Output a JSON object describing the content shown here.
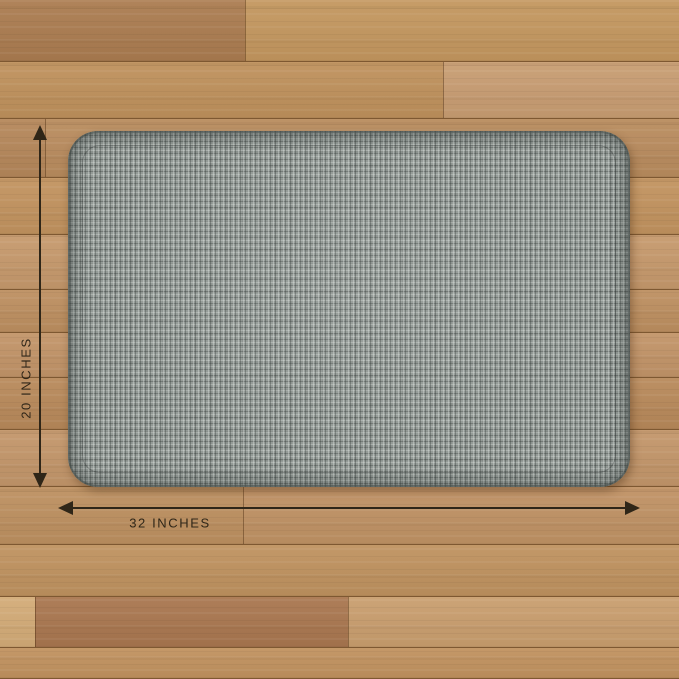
{
  "image": {
    "type": "product-dimension-photo",
    "subject": "Heather gray woven anti-fatigue floor mat lying on a wooden plank floor",
    "mat": {
      "texture": "fine woven crosshatch fabric, rounded corners, beveled edge",
      "width_label": "32 INCHES",
      "height_label": "20 INCHES"
    }
  },
  "annotations": {
    "height_dimension": {
      "label": "20 INCHES",
      "orientation": "vertical"
    },
    "width_dimension": {
      "label": "32 INCHES",
      "orientation": "horizontal"
    }
  },
  "colors": {
    "annotation": "#2f2618",
    "mat_base": "#949b97",
    "mat_light_thread": "#c3c8c4",
    "mat_dark_thread": "#4f5553",
    "mat_edge": "#6b736f",
    "floor_base": "#bf915c",
    "plank_seam": "rgba(72,42,14,0.55)"
  },
  "floor": {
    "plank_rows": [
      {
        "top": 0,
        "height": 62,
        "boards": [
          {
            "left": 0,
            "color": "#ab7c50"
          },
          {
            "left": 245,
            "color": "#c4975f"
          }
        ]
      },
      {
        "top": 62,
        "height": 57,
        "boards": [
          {
            "left": 0,
            "color": "#bf915c"
          },
          {
            "left": 443,
            "color": "#c89d72"
          }
        ]
      },
      {
        "top": 119,
        "height": 59,
        "boards": [
          {
            "left": 0,
            "color": "#b5875a"
          },
          {
            "left": 45,
            "color": "#b98c5e"
          }
        ]
      },
      {
        "top": 178,
        "height": 57,
        "boards": [
          {
            "left": 0,
            "color": "#c2935f"
          }
        ]
      },
      {
        "top": 235,
        "height": 55,
        "boards": [
          {
            "left": 0,
            "color": "#c6996c"
          }
        ]
      },
      {
        "top": 290,
        "height": 43,
        "boards": [
          {
            "left": 0,
            "color": "#bd8f60"
          }
        ]
      },
      {
        "top": 333,
        "height": 45,
        "boards": [
          {
            "left": 0,
            "color": "#c29468"
          }
        ]
      },
      {
        "top": 378,
        "height": 52,
        "boards": [
          {
            "left": 0,
            "color": "#b8895a"
          }
        ]
      },
      {
        "top": 430,
        "height": 57,
        "boards": [
          {
            "left": 0,
            "color": "#c3966a"
          }
        ]
      },
      {
        "top": 487,
        "height": 58,
        "boards": [
          {
            "left": 0,
            "color": "#bd9060"
          },
          {
            "left": 243,
            "color": "#c09264"
          }
        ]
      },
      {
        "top": 545,
        "height": 52,
        "boards": [
          {
            "left": 0,
            "color": "#bf925f"
          }
        ]
      },
      {
        "top": 597,
        "height": 51,
        "boards": [
          {
            "left": 0,
            "color": "#d3ab77"
          },
          {
            "left": 35,
            "color": "#a9764f"
          },
          {
            "left": 348,
            "color": "#c99e6e"
          }
        ]
      },
      {
        "top": 648,
        "height": 31,
        "boards": [
          {
            "left": 0,
            "color": "#c1925f"
          }
        ]
      }
    ]
  }
}
